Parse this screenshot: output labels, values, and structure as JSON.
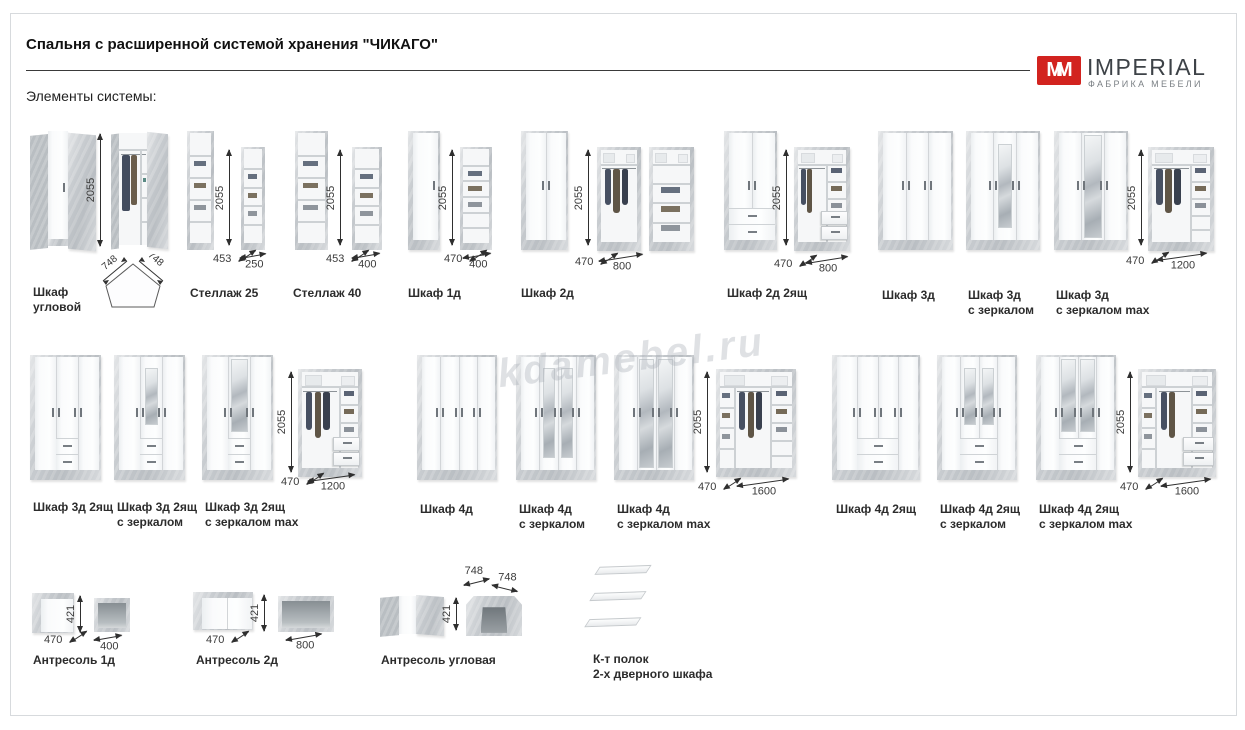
{
  "page": {
    "title": "Спальня с расширенной системой хранения \"ЧИКАГО\"",
    "subtitle": "Элементы системы:",
    "watermark": "kdamebel.ru",
    "logo": {
      "monogram": "MM",
      "name": "IMPERIAL",
      "tagline": "ФАБРИКА МЕБЕЛИ",
      "accent": "#d2231f"
    }
  },
  "items": [
    {
      "id": "shkaf-uglovoy",
      "label": [
        "Шкаф",
        "угловой"
      ],
      "dims": {
        "height": "2055",
        "side_a": "748",
        "side_b": "748"
      }
    },
    {
      "id": "stellazh-25",
      "label": [
        "Стеллаж 25"
      ],
      "dims": {
        "height": "2055",
        "depth": "453",
        "width": "250"
      }
    },
    {
      "id": "stellazh-40",
      "label": [
        "Стеллаж 40"
      ],
      "dims": {
        "height": "2055",
        "depth": "453",
        "width": "400"
      }
    },
    {
      "id": "shkaf-1d",
      "label": [
        "Шкаф 1д"
      ],
      "dims": {
        "height": "2055",
        "depth": "470",
        "width": "400"
      }
    },
    {
      "id": "shkaf-2d",
      "label": [
        "Шкаф 2д"
      ],
      "dims": {
        "height": "2055",
        "depth": "470",
        "width": "800"
      }
    },
    {
      "id": "shkaf-2d-2yashch",
      "label": [
        "Шкаф 2д 2ящ"
      ],
      "dims": {
        "height": "2055",
        "depth": "470",
        "width": "800"
      }
    },
    {
      "id": "shkaf-3d",
      "label": [
        "Шкаф 3д"
      ]
    },
    {
      "id": "shkaf-3d-zerkalo",
      "label": [
        "Шкаф 3д",
        "с зеркалом"
      ]
    },
    {
      "id": "shkaf-3d-zerkalo-max",
      "label": [
        "Шкаф 3д",
        "с зеркалом max"
      ],
      "dims": {
        "height": "2055",
        "depth": "470",
        "width": "1200"
      }
    },
    {
      "id": "shkaf-3d-2yashch",
      "label": [
        "Шкаф 3д 2ящ"
      ]
    },
    {
      "id": "shkaf-3d-2yashch-zerkalo",
      "label": [
        "Шкаф 3д 2ящ",
        "с зеркалом"
      ]
    },
    {
      "id": "shkaf-3d-2yashch-zerkalo-max",
      "label": [
        "Шкаф 3д 2ящ",
        "с зеркалом max"
      ],
      "dims": {
        "height": "2055",
        "depth": "470",
        "width": "1200"
      }
    },
    {
      "id": "shkaf-4d",
      "label": [
        "Шкаф 4д"
      ]
    },
    {
      "id": "shkaf-4d-zerkalo",
      "label": [
        "Шкаф 4д",
        "с зеркалом"
      ]
    },
    {
      "id": "shkaf-4d-zerkalo-max",
      "label": [
        "Шкаф 4д",
        "с зеркалом max"
      ],
      "dims": {
        "height": "2055",
        "depth": "470",
        "width": "1600"
      }
    },
    {
      "id": "shkaf-4d-2yashch",
      "label": [
        "Шкаф 4д 2ящ"
      ]
    },
    {
      "id": "shkaf-4d-2yashch-zerkalo",
      "label": [
        "Шкаф 4д 2ящ",
        "с зеркалом"
      ]
    },
    {
      "id": "shkaf-4d-2yashch-zerkalo-max",
      "label": [
        "Шкаф 4д 2ящ",
        "с зеркалом max"
      ],
      "dims": {
        "height": "2055",
        "depth": "470",
        "width": "1600"
      }
    },
    {
      "id": "antresol-1d",
      "label": [
        "Антресоль 1д"
      ],
      "dims": {
        "height": "421",
        "depth": "470",
        "width": "400"
      }
    },
    {
      "id": "antresol-2d",
      "label": [
        "Антресоль 2д"
      ],
      "dims": {
        "height": "421",
        "depth": "470",
        "width": "800"
      }
    },
    {
      "id": "antresol-uglovaya",
      "label": [
        "Антресоль угловая"
      ],
      "dims": {
        "height": "421",
        "side_a": "748",
        "side_b": "748"
      }
    },
    {
      "id": "komplekt-polok",
      "label": [
        "К-т полок",
        "2-х дверного шкафа"
      ]
    }
  ]
}
